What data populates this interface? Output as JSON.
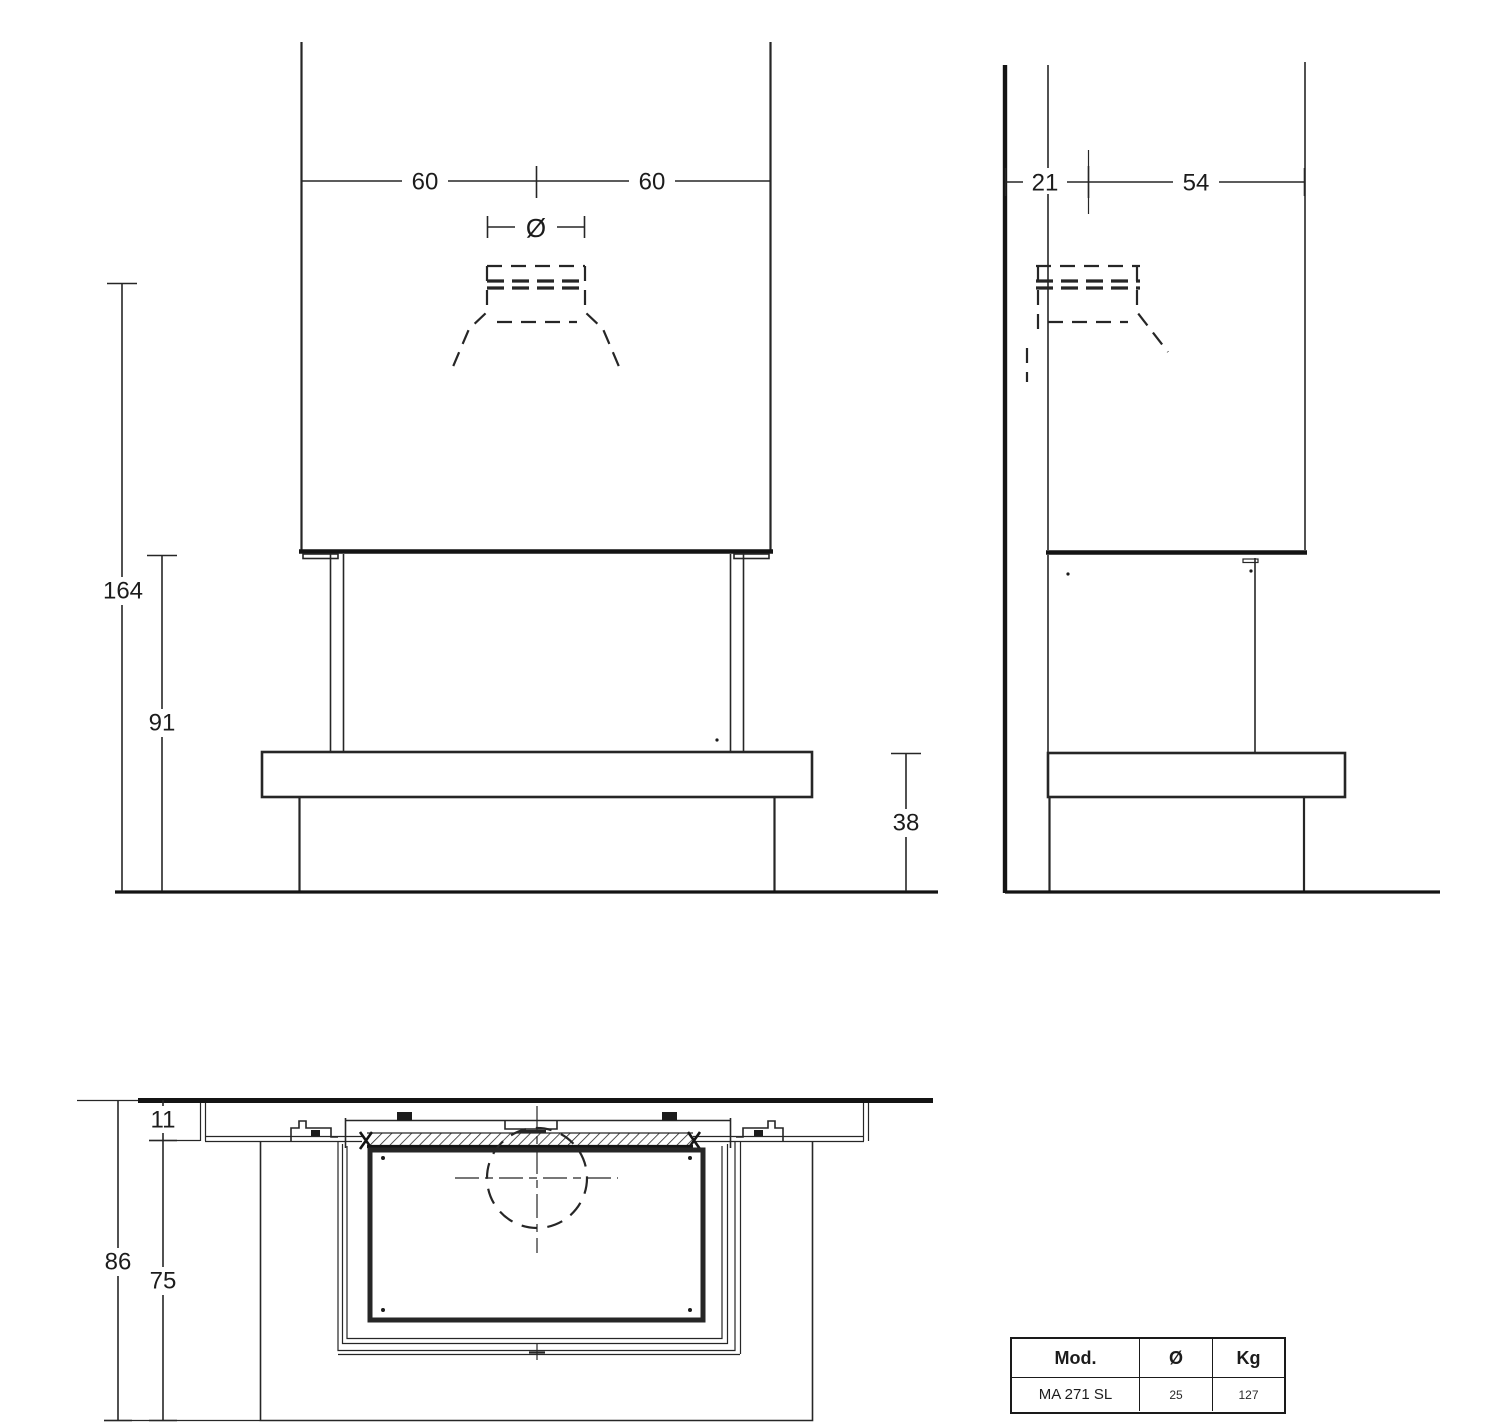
{
  "drawing": {
    "colors": {
      "line": "#262626",
      "thick_line": "#141414",
      "background": "#ffffff"
    },
    "front_view": {
      "dim_left_width": "60",
      "dim_right_width": "60",
      "dim_flue_diameter_symbol": "Ø",
      "dim_total_height": "164",
      "dim_opening_height": "91",
      "dim_bench_height": "38"
    },
    "side_view": {
      "dim_flue_offset": "21",
      "dim_hood_depth": "54"
    },
    "plan_view": {
      "dim_wall_clearance": "11",
      "dim_total_depth": "86",
      "dim_bench_depth": "75"
    },
    "spec_table": {
      "headers": [
        "Mod.",
        "Ø",
        "Kg"
      ],
      "row": [
        "MA 271 SL",
        "25",
        "127"
      ]
    }
  }
}
